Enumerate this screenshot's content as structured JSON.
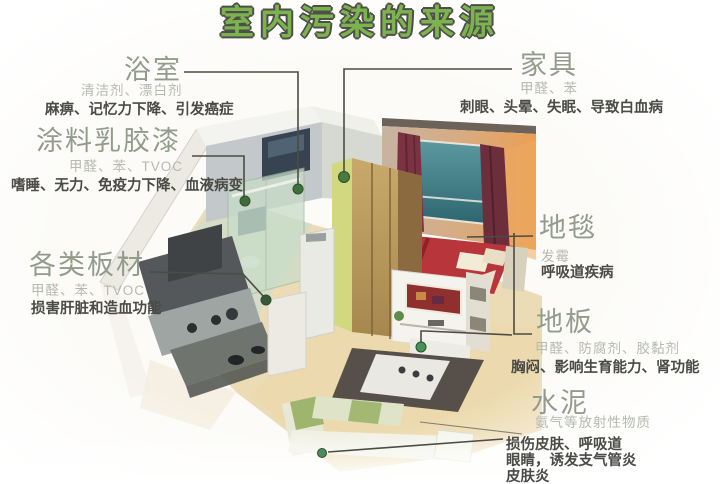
{
  "title": "室内污染的来源",
  "sources": {
    "bathroom": {
      "name": "浴室",
      "pollutants": "清洁剂、漂白剂",
      "harms": "麻痹、记忆力下降、引发癌症"
    },
    "paint": {
      "name": "涂料乳胶漆",
      "pollutants": "甲醛、苯、TVOC",
      "harms": "嗜睡、无力、免疫力下降、血液病变"
    },
    "boards": {
      "name": "各类板材",
      "pollutants": "甲醛、苯、TVOC",
      "harms": "损害肝脏和造血功能"
    },
    "furniture": {
      "name": "家具",
      "pollutants": "甲醛、苯",
      "harms": "刺眼、头晕、失眠、导致白血病"
    },
    "carpet": {
      "name": "地毯",
      "pollutants": "发霉",
      "harms": "呼吸道疾病"
    },
    "floor": {
      "name": "地板",
      "pollutants": "甲醛、防腐剂、胶黏剂",
      "harms": "胸闷、影响生育能力、肾功能"
    },
    "cement": {
      "name": "水泥",
      "pollutants": "氨气等放射性物质",
      "harms_line1": "损伤皮肤、呼吸道",
      "harms_line2": "眼睛，诱发支气管炎",
      "harms_line3": "皮肤炎"
    }
  },
  "colors": {
    "title_green": "#7cb34e",
    "title_outline": "#4e4e4a",
    "heading_gray_green": "#939c8c",
    "pollutant_gray": "#b5bab0",
    "harm_dark": "#4a4a46",
    "connector_line": "#4c4c44",
    "pointer_dot_green": "#3f6f3d"
  }
}
